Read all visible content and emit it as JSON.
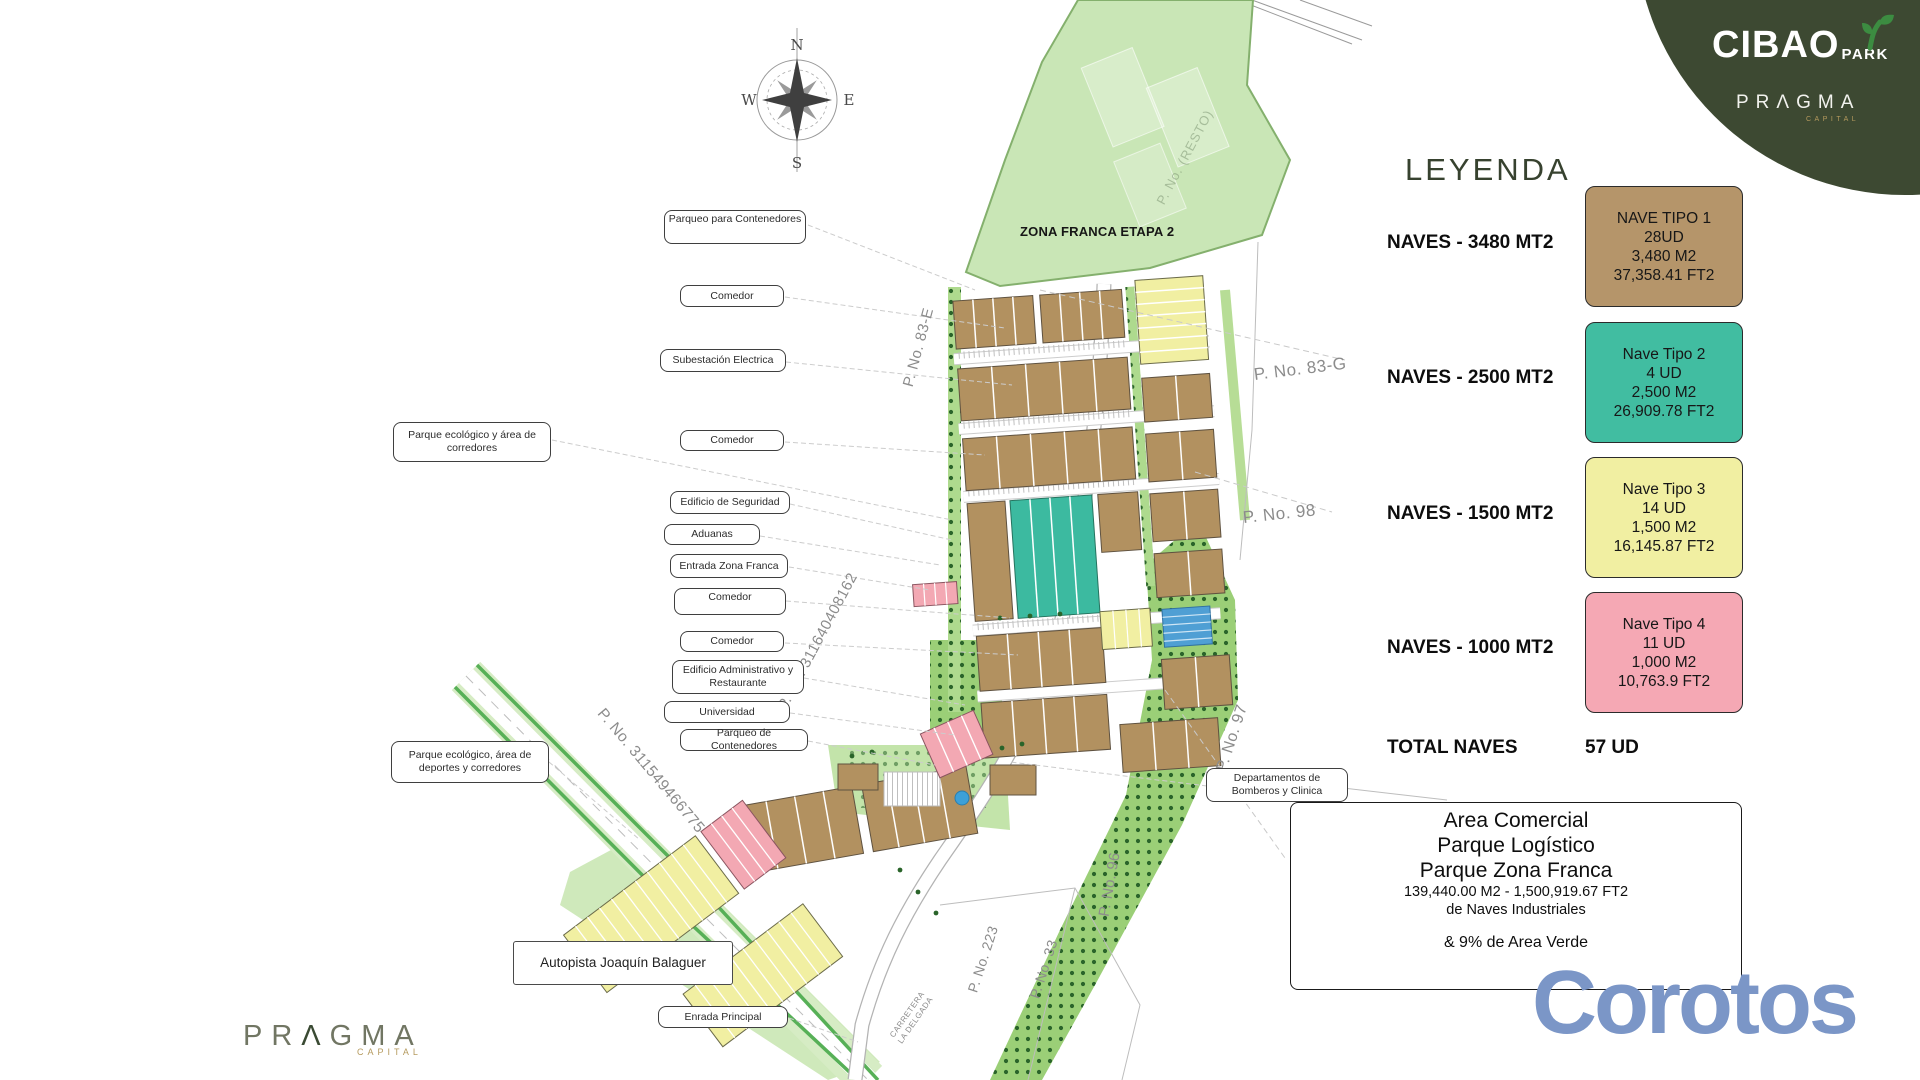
{
  "branding": {
    "cibao": "CIBAO",
    "park": "PARK",
    "pragma": "PRΛGMA",
    "capital": "CAPITAL",
    "circle_color": "#3d4932",
    "leaf_color": "#3c8c41",
    "gold_color": "#b59a5e"
  },
  "footer_logo": {
    "p1": "PR",
    "lambda": "Λ",
    "p2": "GMA",
    "capital": "CAPITAL"
  },
  "watermark": {
    "text": "Corotos",
    "color": "#7b96c7"
  },
  "compass": {
    "n": "N",
    "s": "S",
    "e": "E",
    "w": "W"
  },
  "legend": {
    "title": "LEYENDA",
    "rows": [
      {
        "label": "NAVES - 3480 MT2",
        "box": {
          "color": "#b5956a",
          "lines": [
            "NAVE TIPO 1",
            "28UD",
            "3,480 M2",
            "37,358.41 FT2"
          ]
        }
      },
      {
        "label": "NAVES - 2500 MT2",
        "box": {
          "color": "#41bda1",
          "lines": [
            "Nave Tipo 2",
            "4 UD",
            "2,500 M2",
            "26,909.78 FT2"
          ]
        }
      },
      {
        "label": "NAVES - 1500 MT2",
        "box": {
          "color": "#f1efa2",
          "lines": [
            "Nave Tipo 3",
            "14 UD",
            "1,500 M2",
            "16,145.87 FT2"
          ]
        }
      },
      {
        "label": "NAVES - 1000 MT2",
        "box": {
          "color": "#f5a8b4",
          "lines": [
            "Nave Tipo 4",
            "11 UD",
            "1,000 M2",
            "10,763.9 FT2"
          ]
        }
      }
    ],
    "total_label": "TOTAL NAVES",
    "total_value": "57 UD"
  },
  "info_box": {
    "line1": "Area Comercial",
    "line2": "Parque Logístico",
    "line3": "Parque Zona Franca",
    "line4": "139,440.00 M2 - 1,500,919.67 FT2",
    "line5": "de Naves Industriales",
    "line6": "& 9% de Area Verde"
  },
  "map": {
    "zone_label": "ZONA FRANCA ETAPA 2",
    "resto_label": "P. No. (RESTO)",
    "road_labels": [
      {
        "text": "P. No. 83-E"
      },
      {
        "text": "P. No. 83-G"
      },
      {
        "text": "P. No. 98"
      },
      {
        "text": "P. No. 97"
      },
      {
        "text": "P. No. 96"
      },
      {
        "text": "P. No. 223"
      },
      {
        "text": "P. No. 33"
      },
      {
        "text": "P. No. 311640408162"
      },
      {
        "text": "P. No. 311549466775"
      },
      {
        "text": "CARRETERA LA DELGADA"
      }
    ],
    "callouts": [
      {
        "text": "Parqueo para Contenedores"
      },
      {
        "text": "Comedor"
      },
      {
        "text": "Subestación Electrica"
      },
      {
        "text": "Parque ecológico y área de corredores"
      },
      {
        "text": "Comedor"
      },
      {
        "text": "Edificio de Seguridad"
      },
      {
        "text": "Aduanas"
      },
      {
        "text": "Entrada Zona Franca"
      },
      {
        "text": "Comedor"
      },
      {
        "text": "Comedor"
      },
      {
        "text": "Edificio Administrativo y Restaurante"
      },
      {
        "text": "Universidad"
      },
      {
        "text": "Parqueo de Contenedores"
      },
      {
        "text": "Parque ecológico, área de deportes y corredores"
      },
      {
        "text": "Departamentos de Bomberos y Clinica"
      },
      {
        "text": "Autopista Joaquín Balaguer"
      },
      {
        "text": "Enrada Principal"
      }
    ],
    "colors": {
      "nave_tan": "#b29160",
      "nave_teal": "#3cbaa0",
      "nave_yellow": "#f1efa2",
      "nave_pink": "#f3a8b3",
      "zone_green": "#c9e6b6",
      "orchard_green": "#9bcf77",
      "tree_dot": "#2a642a",
      "highway_green": "#57b057"
    }
  }
}
